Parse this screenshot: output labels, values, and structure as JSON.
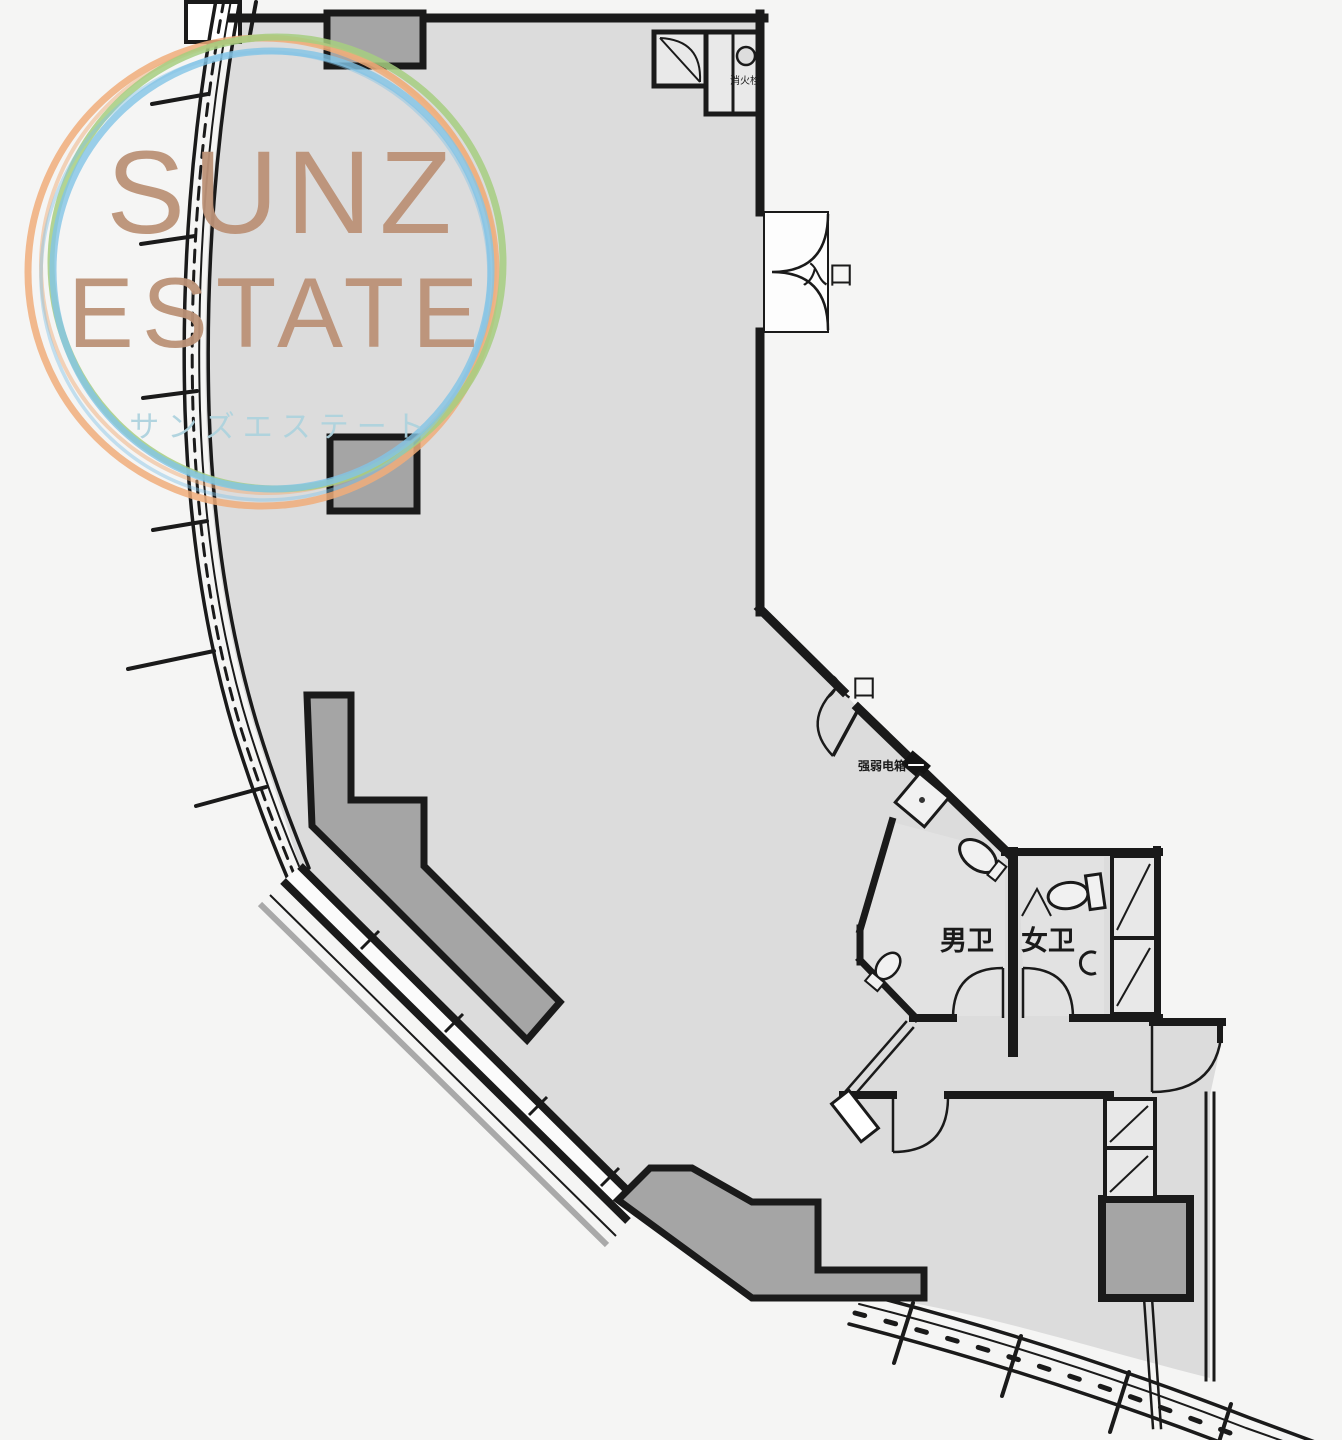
{
  "watermark": {
    "line1": "SUNZ",
    "line2": "ESTATE",
    "line3": "サンズエステート",
    "text_color": "#bc9277",
    "jp_color": "#aed3de",
    "circle_colors": {
      "orange": "#f0ad7a",
      "blue": "#82c4e6",
      "green": "#a6ce80"
    }
  },
  "labels": {
    "entrance_top": "入口",
    "entrance_side": "入口",
    "mens_toilet": "男卫",
    "womens_toilet": "女卫",
    "fire_hydrant": "消火栓",
    "electrical_box": "强弱电箱"
  },
  "palette": {
    "background": "#f5f5f4",
    "floor": "#dcdcdc",
    "room": "#e2e2e2",
    "wall": "#1a1a1a",
    "column": "#a5a5a5",
    "fixture": "#f1f1f1",
    "recess": "#fdfdfd"
  }
}
